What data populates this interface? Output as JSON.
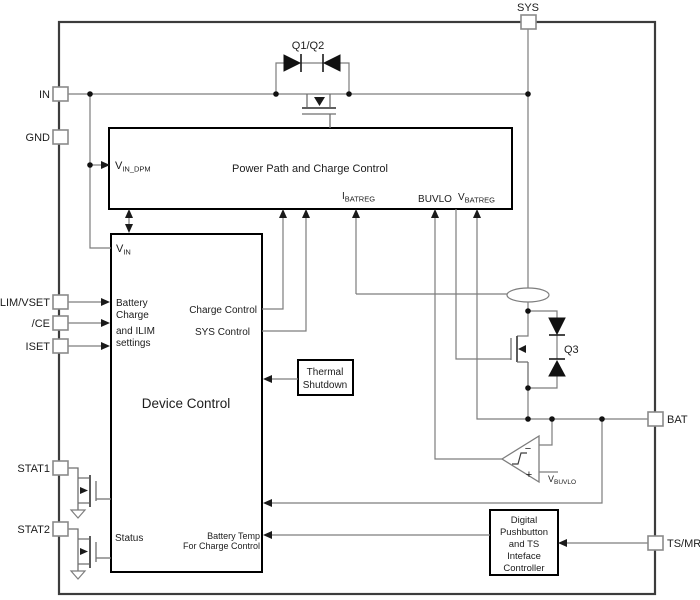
{
  "pins": {
    "sys": "SYS",
    "in": "IN",
    "gnd": "GND",
    "ilim_vset": "ILIM/VSET",
    "ce": "/CE",
    "iset": "ISET",
    "stat1": "STAT1",
    "stat2": "STAT2",
    "bat": "BAT",
    "ts_mr": "TS/MR"
  },
  "power_path": {
    "title": "Power Path and Charge Control",
    "vin_dpm": {
      "main": "V",
      "sub": "IN_DPM"
    },
    "ibatreg": {
      "main": "I",
      "sub": "BATREG"
    },
    "buvlo": "BUVLO",
    "vbatreg": {
      "main": "V",
      "sub": "BATREG"
    }
  },
  "device_control": {
    "title": "Device Control",
    "vin": {
      "main": "V",
      "sub": "IN"
    },
    "settings": [
      "Battery",
      "Charge",
      "and ILIM",
      "settings"
    ],
    "charge_control": "Charge Control",
    "sys_control": "SYS Control",
    "status": "Status",
    "battery_temp": [
      "Battery Temp",
      "For Charge Control"
    ]
  },
  "thermal_shutdown": {
    "lines": [
      "Thermal",
      "Shutdown"
    ]
  },
  "digital_block": {
    "lines": [
      "Digital",
      "Pushbutton",
      "and TS",
      "Inteface",
      "Controller"
    ]
  },
  "transistors": {
    "q1q2": "Q1/Q2",
    "q3": "Q3"
  },
  "comparator": {
    "minus": "−",
    "plus": "+",
    "ref": {
      "main": "V",
      "sub": "BUVLO"
    }
  },
  "colors": {
    "background": "#ffffff",
    "wire": "#7d7d7d",
    "block_border": "#000000",
    "outer_border": "#3c3c3c",
    "text": "#1c1c1c"
  }
}
